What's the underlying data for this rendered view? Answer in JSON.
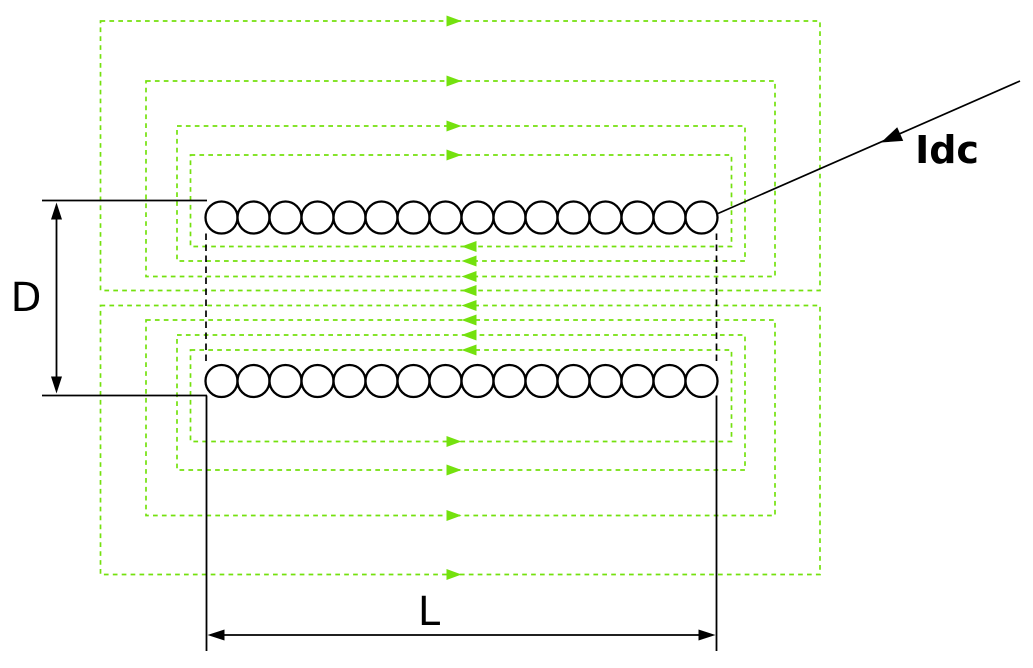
{
  "canvas": {
    "width": 1033,
    "height": 668,
    "background": "#ffffff"
  },
  "colors": {
    "field_line": "#74e10e",
    "ink": "#000000",
    "coil_fill": "#ffffff"
  },
  "labels": {
    "diameter": "D",
    "length": "L",
    "current": "Idc"
  },
  "coil": {
    "turns_per_row": 16,
    "turn_radius": 16,
    "first_center_x": 221.5,
    "spacing": 32,
    "stroke_width": 2.3,
    "rows": [
      {
        "name": "top-winding-row",
        "center_y": 217.5
      },
      {
        "name": "bottom-winding-row",
        "center_y": 381
      }
    ]
  },
  "field_loops": {
    "count": 8,
    "dash": "4.7 4.2",
    "stroke_width": 1.7,
    "arrow_tip_x": 461.5,
    "arrow_len": 15,
    "arrow_half_w": 5.5,
    "top": [
      {
        "left": 190.5,
        "top": 155,
        "right": 731.5,
        "bottom": 246.5
      },
      {
        "left": 177,
        "top": 126,
        "right": 745,
        "bottom": 261
      },
      {
        "left": 146,
        "top": 81,
        "right": 775,
        "bottom": 276.5
      },
      {
        "left": 100.5,
        "top": 21,
        "right": 820,
        "bottom": 290.5
      }
    ],
    "bottom": [
      {
        "left": 190.5,
        "top": 350,
        "right": 731.5,
        "bottom": 441.5
      },
      {
        "left": 177,
        "top": 335,
        "right": 745,
        "bottom": 470
      },
      {
        "left": 146,
        "top": 320,
        "right": 775,
        "bottom": 515.5
      },
      {
        "left": 100.5,
        "top": 305.5,
        "right": 820,
        "bottom": 574.5
      }
    ],
    "outer_arrow_dir": "right",
    "inner_arrow_dir": "left"
  },
  "bore_edges": {
    "dash": "6.5 4.5",
    "stroke_width": 1.7,
    "xs": [
      206,
      716.5
    ],
    "y1": 233.5,
    "y2": 365
  },
  "dim_D": {
    "ext_x1": 42,
    "ext_x2": 207,
    "ext_top_y": 200.5,
    "ext_bottom_y": 395.5,
    "arrow_x": 56.5,
    "tip_top_y": 202.5,
    "tip_bottom_y": 393.5,
    "head_len": 17,
    "head_half_w": 5.5,
    "stroke_width": 1.8,
    "label_x": 26,
    "label_y": 298
  },
  "dim_L": {
    "wall_xs": [
      206.5,
      716.5
    ],
    "wall_y1": 395.5,
    "wall_y2": 651,
    "arrow_y": 635,
    "tip_left_x": 207.5,
    "tip_right_x": 715.5,
    "head_len": 17,
    "head_half_w": 5.5,
    "stroke_width": 1.8,
    "label_x": 429,
    "label_y": 612
  },
  "current_lead": {
    "x1": 718,
    "y1": 213.5,
    "x2": 1020,
    "y2": 81,
    "arrow_tip_x": 881,
    "arrow_tip_y": 142.5,
    "head_len": 21,
    "head_half_w": 7.5,
    "stroke_width": 1.7,
    "label_x": 947,
    "label_y": 150
  }
}
